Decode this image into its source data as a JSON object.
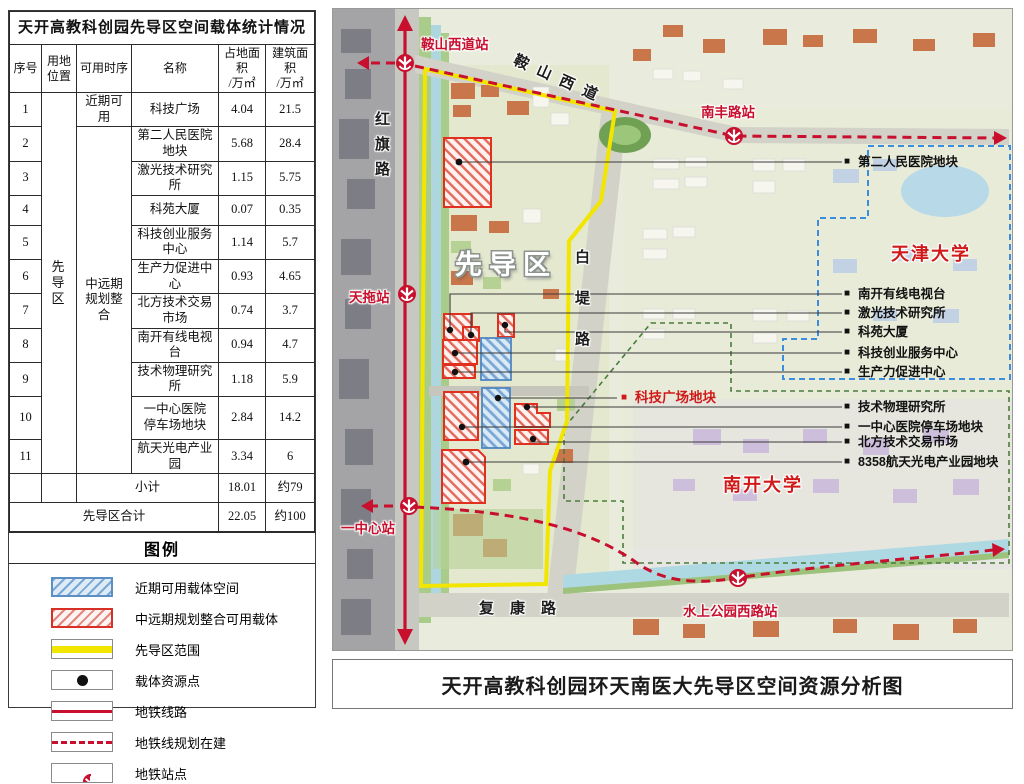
{
  "table": {
    "title": "天开高教科创园先导区空间载体统计情况",
    "headers": {
      "no": "序号",
      "location": "用地\n位置",
      "timing": "可用时序",
      "name": "名称",
      "land": "占地面积\n/万㎡",
      "building": "建筑面积\n/万㎡"
    },
    "location_label": "先\n导\n区",
    "timing_near": "近期可用",
    "timing_mid": "中远期\n规划整合",
    "rows": [
      {
        "no": "1",
        "name": "科技广场",
        "land": "4.04",
        "building": "21.5"
      },
      {
        "no": "2",
        "name": "第二人民医院地块",
        "land": "5.68",
        "building": "28.4"
      },
      {
        "no": "3",
        "name": "激光技术研究所",
        "land": "1.15",
        "building": "5.75"
      },
      {
        "no": "4",
        "name": "科苑大厦",
        "land": "0.07",
        "building": "0.35"
      },
      {
        "no": "5",
        "name": "科技创业服务中心",
        "land": "1.14",
        "building": "5.7"
      },
      {
        "no": "6",
        "name": "生产力促进中心",
        "land": "0.93",
        "building": "4.65"
      },
      {
        "no": "7",
        "name": "北方技术交易市场",
        "land": "0.74",
        "building": "3.7"
      },
      {
        "no": "8",
        "name": "南开有线电视台",
        "land": "0.94",
        "building": "4.7"
      },
      {
        "no": "9",
        "name": "技术物理研究所",
        "land": "1.18",
        "building": "5.9"
      },
      {
        "no": "10",
        "name": "一中心医院\n停车场地块",
        "land": "2.84",
        "building": "14.2"
      },
      {
        "no": "11",
        "name": "航天光电产业园",
        "land": "3.34",
        "building": "6"
      }
    ],
    "subtotal": {
      "label": "小计",
      "land": "18.01",
      "building": "约79"
    },
    "total": {
      "label": "先导区合计",
      "land": "22.05",
      "building": "约100"
    }
  },
  "legend": {
    "title": "图例",
    "items": [
      "近期可用载体空间",
      "中远期规划整合可用载体",
      "先导区范围",
      "载体资源点",
      "地铁线路",
      "地铁线规划在建",
      "地铁站点"
    ]
  },
  "map": {
    "bullet": "■",
    "stations": [
      "鞍山西道站",
      "南丰路站",
      "天拖站",
      "一中心站",
      "水上公园西路站"
    ],
    "roads": {
      "hongqi": "红旗路",
      "anshan": "鞍山西道",
      "baidi": "白堤路",
      "fukang": "复康路"
    },
    "area_label": "先导区",
    "universities": {
      "tianjin": "天津大学",
      "nankai": "南开大学"
    },
    "red_label": "科技广场地块",
    "callout_top": "第二人民医院地块",
    "callouts_mid": [
      "南开有线电视台",
      "激光技术研究所",
      "科苑大厦",
      "科技创业服务中心",
      "生产力促进中心"
    ],
    "callouts_bottom": [
      "技术物理研究所",
      "一中心医院停车场地块",
      "北方技术交易市场",
      "8358航天光电产业园地块"
    ]
  },
  "footer": {
    "title": "天开高教科创园环天南医大先导区空间资源分析图"
  },
  "colors": {
    "metro_red": "#c8102e",
    "boundary_yellow": "#f2e600",
    "near_term_blue": "#5b8fc4",
    "mid_term_red": "#d93025",
    "tianjin_univ_blue": "#3b8ede",
    "nankai_univ_green": "#4a7d3a"
  }
}
